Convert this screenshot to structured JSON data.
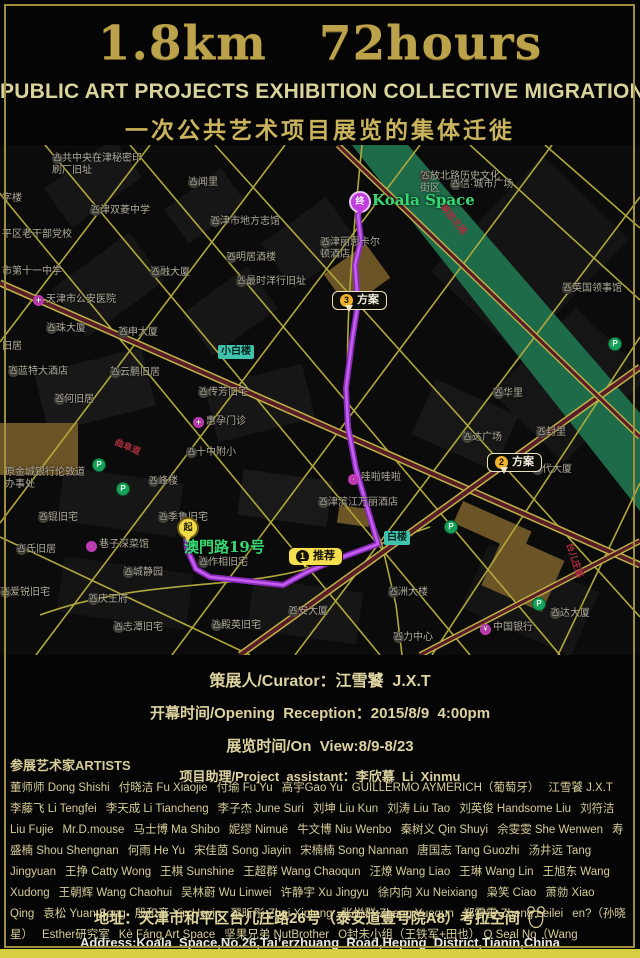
{
  "colors": {
    "gold": "#bda24c",
    "pale_gold": "#d9d49c",
    "cn_gold": "#c9b35c",
    "route_purple": "#b840ea",
    "river_green": "#1e6b4a",
    "road_yellow": "#b0a83c",
    "road_maroon": "#5a1c29",
    "marker_yellow": "#f4df4e",
    "green_text": "#35d873",
    "teal_label": "#41c3ad",
    "bottom_bar": "#d6cf42"
  },
  "poster": {
    "title": "1.8km   72hours",
    "subtitle_en": "PUBLIC ART PROJECTS EXHIBITION COLLECTIVE MIGRATION",
    "subtitle_cn": "一次公共艺术项目展览的集体迁徙"
  },
  "info": {
    "curator": "策展人/Curator：江雪饕  J.X.T",
    "opening": "开幕时间/Opening  Reception：2015/8/9  4:00pm",
    "on_view": "展览时间/On  View:8/9-8/23",
    "assistant": "项目助理/Project  assistant：李欣慕  Li  Xinmu"
  },
  "artists": {
    "heading": "参展艺术家ARTISTS",
    "names": [
      "董师师 Dong Shishi",
      "付晓洁 Fu Xiaojie",
      "付瑜 Fu Yu",
      "高宇Gao Yu",
      "GUILLERMO AYMERICH（葡萄牙）",
      "江雪饕 J.X.T",
      "李藤飞 Li Tengfei",
      "李天成 Li Tiancheng",
      "李子杰 June Suri",
      "刘坤 Liu Kun",
      "刘涛 Liu Tao",
      "刘英俊 Handsome Liu",
      "刘符洁 Liu Fujie",
      "Mr.D.mouse",
      "马士博 Ma Shibo",
      "妮缪 Nimuë",
      "牛文博 Niu Wenbo",
      "秦树义 Qin Shuyi",
      "佘雯雯 She Wenwen",
      "寿盛楠 Shou Shengnan",
      "何雨 He Yu",
      "宋佳茵 Song Jiayin",
      "宋楠楠 Song Nannan",
      "唐国志 Tang Guozhi",
      "汤井远 Tang Jingyuan",
      "王挣 Catty Wong",
      "王棋 Sunshine",
      "王超群 Wang Chaoqun",
      "汪燎 Wang Liao",
      "王琳 Wang Lin",
      "王旭东 Wang Xudong",
      "王朝辉 Wang Chaohui",
      "吴林蔚 Wu Linwei",
      "许静宇 Xu Jingyu",
      "徐内向 Xu Neixiang",
      "枭笑 Ciao",
      "萧勍 Xiao Qing",
      "袁松 Yuan Song",
      "殷和音 Yin Heyin",
      "翟昕彤 Zhai Xintong",
      "张悦群 Zhang Yuequn",
      "郑雷雷 Zheng Leilei",
      "en?（孙晓星）",
      "Esther研究室",
      "Kè Fáng Art Space",
      "坚果兄弟 NutBrother",
      "O封未小组（王铁军+田也） O Seal No（Wang Tiejun+Tian Ye）"
    ]
  },
  "address": {
    "cn": "地址：天津市和平区台儿庄路26号（泰安道壹号院A8）考拉空间",
    "en": "Address:Koala  Space,No.26,Tai’erzhuang  Road,Heping  District,Tianin,China"
  },
  "map": {
    "route_labels": {
      "destination": "Koala Space",
      "origin": "澳門路19号",
      "start_pin": "起",
      "end_pin": "终",
      "marker1_num": "1",
      "marker1_label": "推荐",
      "marker2_num": "2",
      "marker2_label": "方案",
      "marker3_num": "3",
      "marker3_label": "方案"
    },
    "icon_glyphs": {
      "poi": "凸",
      "med": "+",
      "food": "·",
      "bank": "¥"
    },
    "stations": [
      {
        "t": "小白楼",
        "x": 218,
        "y": 200
      },
      {
        "t": "白楼",
        "x": 384,
        "y": 386
      }
    ],
    "streets": [
      {
        "t": "解放北路",
        "x": 448,
        "y": 56,
        "a": 51
      },
      {
        "t": "曲阜道",
        "x": 118,
        "y": 290,
        "a": 23
      },
      {
        "t": "台儿庄路",
        "x": 576,
        "y": 396,
        "a": 72
      }
    ],
    "parking": [
      {
        "x": 92,
        "y": 313
      },
      {
        "x": 116,
        "y": 337
      },
      {
        "x": 608,
        "y": 192
      },
      {
        "x": 532,
        "y": 452
      },
      {
        "x": 444,
        "y": 375
      }
    ],
    "poi": [
      {
        "t": "中共中央在津秘密印刷厂旧址",
        "x": 52,
        "y": 8,
        "w": 92,
        "icon": "poi"
      },
      {
        "t": "达闻里",
        "x": 188,
        "y": 32,
        "icon": "poi"
      },
      {
        "t": "解放北路历史文化街区",
        "x": 420,
        "y": 26,
        "w": 82,
        "icon": "poi"
      },
      {
        "t": "中信·城市广场",
        "x": 450,
        "y": 34,
        "icon": "poi"
      },
      {
        "t": "字楼",
        "x": 2,
        "y": 48
      },
      {
        "t": "天津双菱中学",
        "x": 90,
        "y": 60,
        "icon": "poi"
      },
      {
        "t": "天津市地方志馆",
        "x": 210,
        "y": 71,
        "icon": "poi"
      },
      {
        "t": "平区老干部党校",
        "x": 2,
        "y": 84
      },
      {
        "t": "天津丽思卡尔顿酒店",
        "x": 320,
        "y": 92,
        "w": 62,
        "icon": "poi"
      },
      {
        "t": "正明居酒楼",
        "x": 226,
        "y": 107,
        "icon": "poi"
      },
      {
        "t": "市第十一中学",
        "x": 2,
        "y": 121
      },
      {
        "t": "汇融大厦",
        "x": 150,
        "y": 122,
        "icon": "poi"
      },
      {
        "t": "美最时洋行旧址",
        "x": 236,
        "y": 131,
        "icon": "poi"
      },
      {
        "t": "原英国领事馆",
        "x": 562,
        "y": 138,
        "icon": "poi"
      },
      {
        "t": "天津市公安医院",
        "x": 33,
        "y": 149,
        "icon": "med"
      },
      {
        "t": "海珠大厦",
        "x": 46,
        "y": 178,
        "icon": "poi"
      },
      {
        "t": "茂申大厦",
        "x": 118,
        "y": 182,
        "icon": "poi"
      },
      {
        "t": "旧居",
        "x": 2,
        "y": 196
      },
      {
        "t": "富蓝特大酒店",
        "x": 8,
        "y": 221,
        "icon": "poi"
      },
      {
        "t": "新云鹏旧居",
        "x": 110,
        "y": 222,
        "icon": "poi"
      },
      {
        "t": "那何旧居",
        "x": 54,
        "y": 249,
        "icon": "poi"
      },
      {
        "t": "孙传芳旧宅",
        "x": 198,
        "y": 242,
        "icon": "poi"
      },
      {
        "t": "惠孕门诊",
        "x": 193,
        "y": 271,
        "icon": "med"
      },
      {
        "t": "明华里",
        "x": 493,
        "y": 243,
        "icon": "poi"
      },
      {
        "t": "信达广场",
        "x": 462,
        "y": 287,
        "icon": "poi"
      },
      {
        "t": "开封里",
        "x": 536,
        "y": 282,
        "icon": "poi"
      },
      {
        "t": "外代大厦",
        "x": 532,
        "y": 319,
        "icon": "poi"
      },
      {
        "t": "二十中附小",
        "x": 186,
        "y": 302,
        "icon": "poi"
      },
      {
        "t": "云峰楼",
        "x": 148,
        "y": 331,
        "icon": "poi"
      },
      {
        "t": "原金城银行伦敦道办事处",
        "x": 5,
        "y": 322,
        "w": 82
      },
      {
        "t": "哇啦哇啦",
        "x": 348,
        "y": 327,
        "icon": "food"
      },
      {
        "t": "天津滨江万丽酒店",
        "x": 318,
        "y": 352,
        "icon": "poi"
      },
      {
        "t": "曹锟旧宅",
        "x": 38,
        "y": 367,
        "icon": "poi"
      },
      {
        "t": "孙季鲁旧宅",
        "x": 158,
        "y": 367,
        "icon": "poi"
      },
      {
        "t": "李氏旧居",
        "x": 16,
        "y": 399,
        "icon": "poi"
      },
      {
        "t": "巷子深菜馆",
        "x": 86,
        "y": 394,
        "icon": "food"
      },
      {
        "t": "津城静园",
        "x": 123,
        "y": 422,
        "icon": "poi"
      },
      {
        "t": "张作相旧宅",
        "x": 198,
        "y": 412,
        "icon": "poi"
      },
      {
        "t": "李爱锐旧宅",
        "x": 0,
        "y": 442,
        "icon": "poi"
      },
      {
        "t": "原庆王府",
        "x": 88,
        "y": 449,
        "icon": "poi"
      },
      {
        "t": "张志潭旧宅",
        "x": 113,
        "y": 477,
        "icon": "poi"
      },
      {
        "t": "邦洲大楼",
        "x": 388,
        "y": 442,
        "icon": "poi"
      },
      {
        "t": "平安大厦",
        "x": 288,
        "y": 461,
        "icon": "poi"
      },
      {
        "t": "孙殿英旧宅",
        "x": 211,
        "y": 475,
        "icon": "poi"
      },
      {
        "t": "富力中心",
        "x": 393,
        "y": 487,
        "icon": "poi"
      },
      {
        "t": "泰达大厦",
        "x": 550,
        "y": 463,
        "icon": "poi"
      },
      {
        "t": "中国银行",
        "x": 480,
        "y": 477,
        "icon": "bank"
      }
    ]
  }
}
